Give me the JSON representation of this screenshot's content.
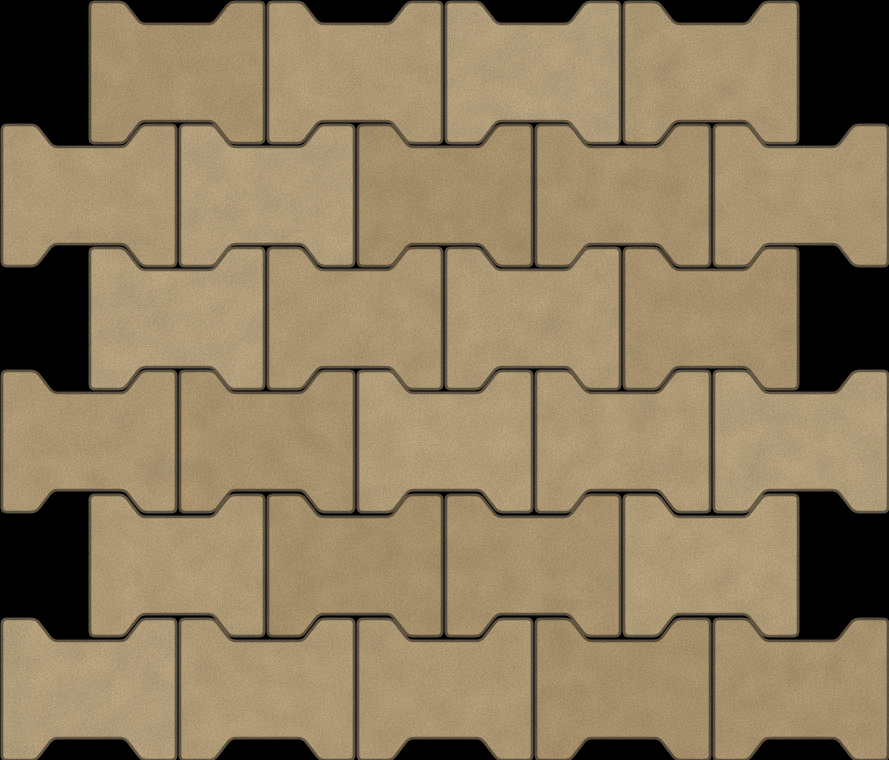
{
  "scene": {
    "description": "Seamless pattern of tan dog-bone interlocking concrete pavers laid in a half-offset running bond on a black background",
    "canvas": {
      "width": 889,
      "height": 760
    },
    "background_color": "#000000",
    "joint_color": "#000000",
    "paver_shape": {
      "width": 174,
      "height": 141,
      "notch_depth": 22,
      "flange_top": 34,
      "slope_run": 17,
      "notch_floor": 72,
      "corner_radius": 5,
      "edge_stroke_width": 2.6,
      "edge_darken": 0.55
    },
    "palette": [
      "#d4ba8e",
      "#ccb185",
      "#d8bf94",
      "#c9ae81",
      "#d1b78b",
      "#d7bd91"
    ],
    "grid": {
      "period_x": 178,
      "rows": [
        {
          "y": 2,
          "x_start": 90,
          "count": 4,
          "tints": [
            1,
            0,
            2,
            4
          ]
        },
        {
          "y": 125,
          "x_start": 2,
          "count": 5,
          "tints": [
            0,
            2,
            3,
            1,
            4
          ]
        },
        {
          "y": 248,
          "x_start": 90,
          "count": 4,
          "tints": [
            2,
            4,
            0,
            1
          ]
        },
        {
          "y": 371,
          "x_start": 2,
          "count": 5,
          "tints": [
            4,
            1,
            5,
            0,
            2
          ]
        },
        {
          "y": 495,
          "x_start": 90,
          "count": 4,
          "tints": [
            0,
            3,
            1,
            5
          ]
        },
        {
          "y": 619,
          "x_start": 2,
          "count": 5,
          "tints": [
            2,
            0,
            4,
            3,
            1
          ]
        }
      ]
    },
    "texture": {
      "speckle_frequency": 0.75,
      "speckle_octaves": 2,
      "speckle_seed": 7,
      "speckle_slope": 0.45,
      "speckle_intercept": 0.62,
      "mottle_frequency": 0.035,
      "mottle_octaves": 3,
      "mottle_seed": 11,
      "mottle_slope": 0.14,
      "mottle_intercept": 0.9
    }
  }
}
